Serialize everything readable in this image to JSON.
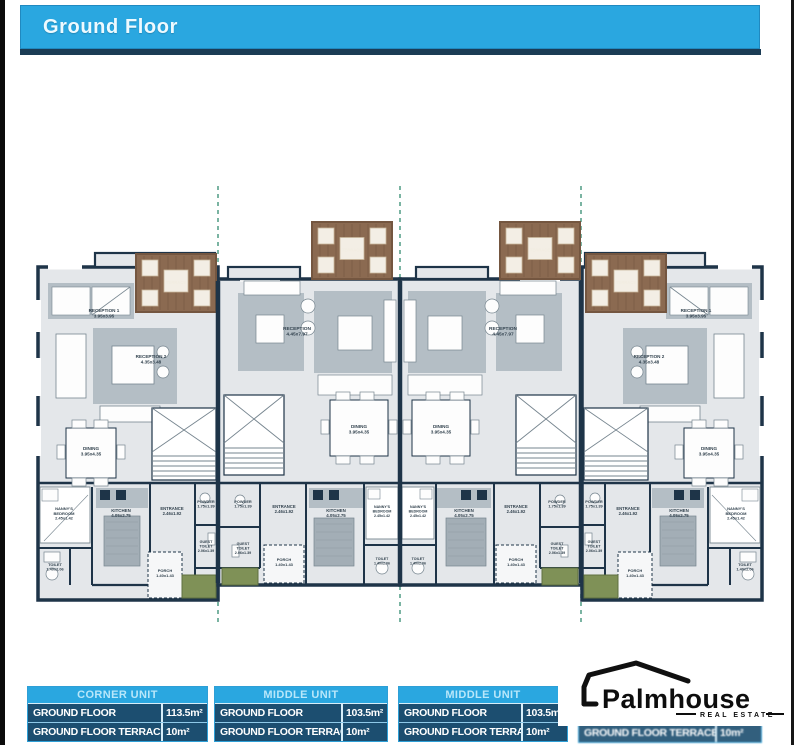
{
  "header": {
    "title": "Ground Floor"
  },
  "plan": {
    "rooms": {
      "reception1": {
        "label": "RECEPTION 1",
        "dims": "3.95x3.95"
      },
      "reception2": {
        "label": "RECEPTION 2",
        "dims": "4.35x3.48"
      },
      "reception": {
        "label": "RECEPTION",
        "dims": "4.45x7.97"
      },
      "dining": {
        "label": "DINING",
        "dims": "3.95x4.35"
      },
      "kitchen": {
        "label": "KITCHEN",
        "dims": "4.05x2.75"
      },
      "nanny": {
        "label": "NANNY'S BEDROOM",
        "dims": "2.45x1.42"
      },
      "entrance": {
        "label": "ENTRANCE",
        "dims": "2.46x1.92"
      },
      "powder": {
        "label": "POWDER",
        "dims": "1.75x1.39"
      },
      "guest_toilet": {
        "label": "GUEST TOILET",
        "dims": "2.06x1.39"
      },
      "toilet": {
        "label": "TOILET",
        "dims": "1.40x2.06"
      },
      "porch": {
        "label": "PORCH",
        "dims": "1.40x1.43"
      },
      "terrace": {
        "label": "TERRACE",
        "dims": ""
      }
    }
  },
  "tables": [
    {
      "header": "CORNER UNIT",
      "rows": [
        [
          "GROUND FLOOR",
          "113.5m²"
        ],
        [
          "GROUND FLOOR TERRACE",
          "10m²"
        ]
      ]
    },
    {
      "header": "MIDDLE UNIT",
      "rows": [
        [
          "GROUND FLOOR",
          "103.5m²"
        ],
        [
          "GROUND FLOOR TERRACE",
          "10m²"
        ]
      ]
    },
    {
      "header": "MIDDLE UNIT",
      "rows": [
        [
          "GROUND FLOOR",
          "103.5m²"
        ],
        [
          "GROUND FLOOR TERRACE",
          "10m²"
        ]
      ]
    },
    {
      "partial": true,
      "rows": [
        [
          "GROUND FLOOR TERRACE",
          "10m²"
        ]
      ]
    }
  ],
  "logo": {
    "brand": "Palmhouse",
    "tagline": "REAL ESTATE"
  },
  "colors": {
    "accent_blue": "#2aa7e0",
    "table_navy": "#1c4e70",
    "wall_navy": "#1e3448",
    "floor_gray": "#e4e7ea",
    "furniture_gray": "#b4bec5",
    "terrace_brown": "#8b6a51",
    "planter_green": "#7f9157",
    "boundary_dash_green": "#5aa18c"
  }
}
